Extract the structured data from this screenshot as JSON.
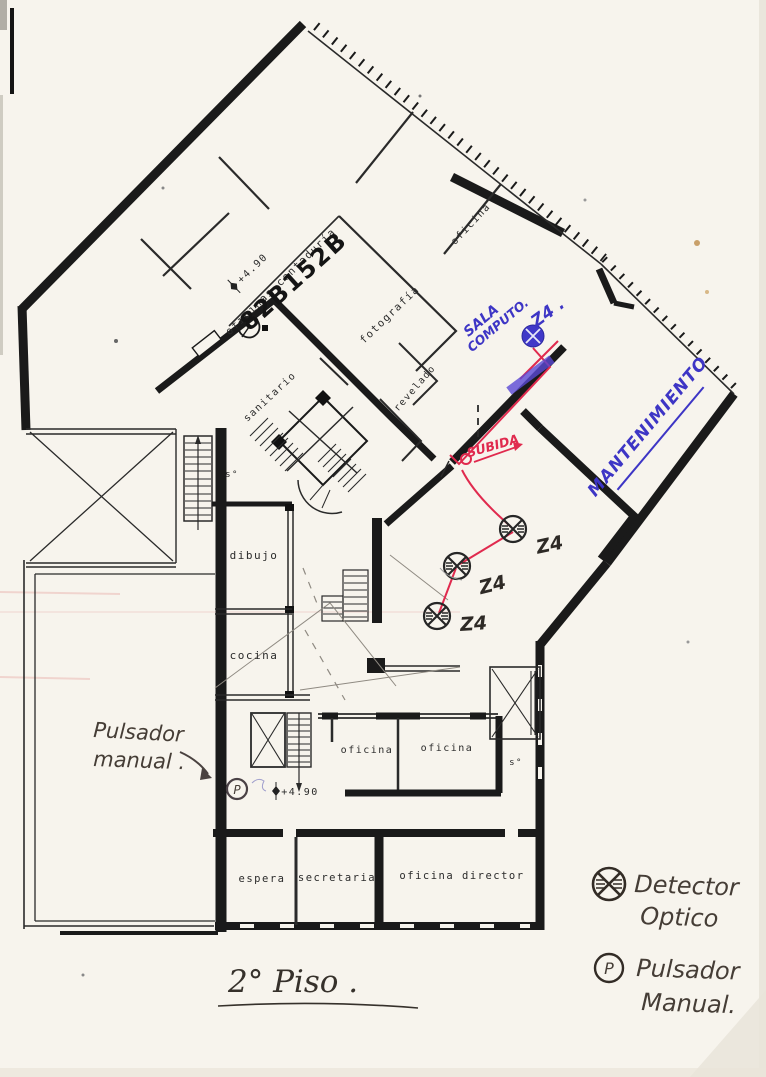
{
  "plan": {
    "floor_title": "2° Piso .",
    "stamp": "82B152B",
    "elevation_upper": "+4.90",
    "elevation_lower": "+4.90",
    "pulsador_p": "P",
    "rooms": {
      "oficinas_contaduria": "oficinas contaduría",
      "oficina_top": "oficina",
      "fotografia": "fotografía",
      "revelado": "revelado",
      "sanitario": "sanitario",
      "s_upper": "s°",
      "dibujo": "dibujo",
      "cocina": "cocina",
      "oficina_left": "oficina",
      "oficina_right": "oficina",
      "s_lower": "s°",
      "espera": "espera",
      "secretaria": "secretaria",
      "oficina_director": "oficina director"
    }
  },
  "annotations": {
    "sala_computo_line1": "SALA",
    "sala_computo_line2": "COMPUTO.",
    "zone_blue": "Z4 .",
    "mantenimiento": "MANTENIMIENTO",
    "subida": "SUBIDA",
    "zone_1": "Z4",
    "zone_2": "Z4",
    "zone_3": "Z4",
    "pulsador_note_line1": "Pulsador",
    "pulsador_note_line2": "manual ."
  },
  "legend": {
    "detector_label_line1": "Detector",
    "detector_label_line2": "Optico",
    "pulsador_symbol": "P",
    "pulsador_label_line1": "Pulsador",
    "pulsador_label_line2": "Manual."
  },
  "colors": {
    "paper": "#f7f4ed",
    "print_black": "#1a1a1a",
    "ink_blue": "#3d35c5",
    "ink_red": "#e02a4e",
    "pencil": "#453d36"
  }
}
